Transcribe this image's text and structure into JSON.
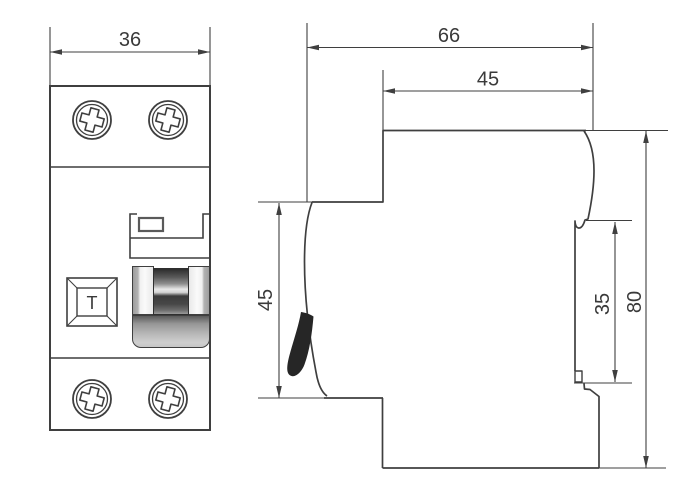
{
  "front_view": {
    "width_label": "36",
    "test_button_label": "T"
  },
  "side_view": {
    "depth_label": "66",
    "upper_depth_label": "45",
    "front_height_label": "45",
    "rail_recess_label": "35",
    "height_label": "80"
  },
  "icons": {
    "screws": "phillips-screw-icon",
    "lever": "din-lever-icon"
  },
  "colors": {
    "background": "#ffffff",
    "line": "#3f3f3f",
    "text": "#3a3a3a",
    "lever_fill": "#262626",
    "toggle_dark": "#2c2c2c",
    "toggle_light": "#f0f0f0"
  }
}
